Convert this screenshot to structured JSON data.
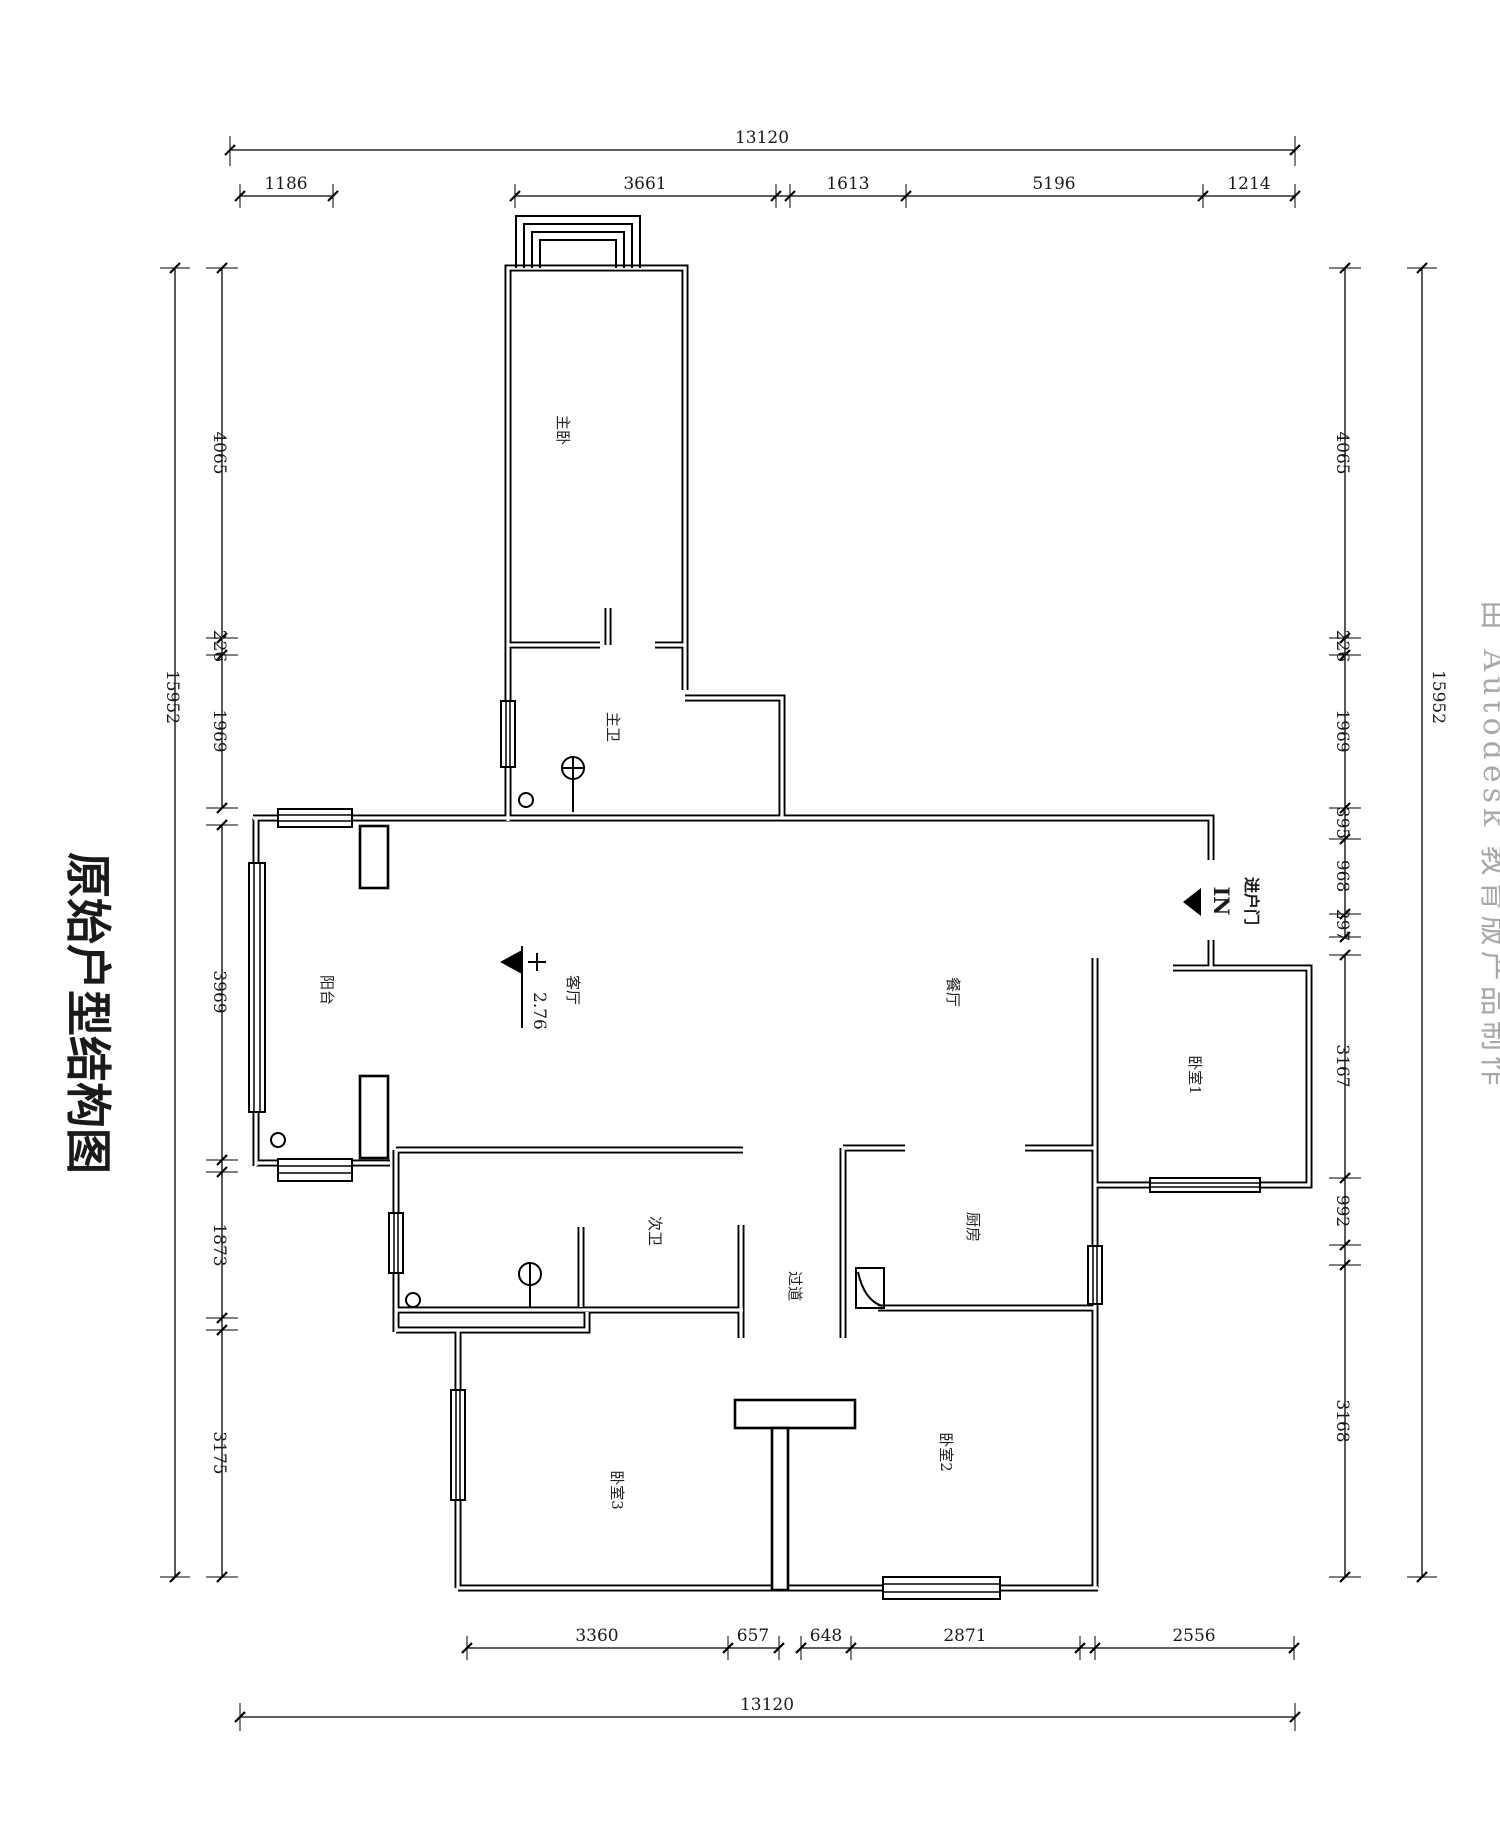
{
  "title": "原始户型结构图",
  "watermark": "由 Autodesk 教育版产品制作",
  "rooms": {
    "master_bedroom": "主卧",
    "master_bath": "主卫",
    "balcony": "阳台",
    "living_room": "客厅",
    "dining_room": "餐厅",
    "bedroom1": "卧室1",
    "kitchen": "厨房",
    "second_bath": "次卫",
    "corridor": "过道",
    "bedroom2": "卧室2",
    "bedroom3": "卧室3"
  },
  "entry": {
    "label": "进户门",
    "arrow_text": "IN"
  },
  "level_mark": {
    "value": "2.76"
  },
  "dimensions": {
    "top": {
      "overall": "13120",
      "segments": [
        "1186",
        "3661",
        "1613",
        "5196",
        "1214"
      ]
    },
    "bottom": {
      "overall": "13120",
      "segments": [
        "3360",
        "657",
        "648",
        "2871",
        "2556"
      ]
    },
    "left": {
      "overall": "15952",
      "segments": [
        "4065",
        "226",
        "1969",
        "3969",
        "1873",
        "3175"
      ]
    },
    "right": {
      "overall": "15952",
      "segments": [
        "4065",
        "226",
        "1969",
        "395",
        "968",
        "297",
        "3167",
        "992",
        "3168"
      ]
    }
  }
}
